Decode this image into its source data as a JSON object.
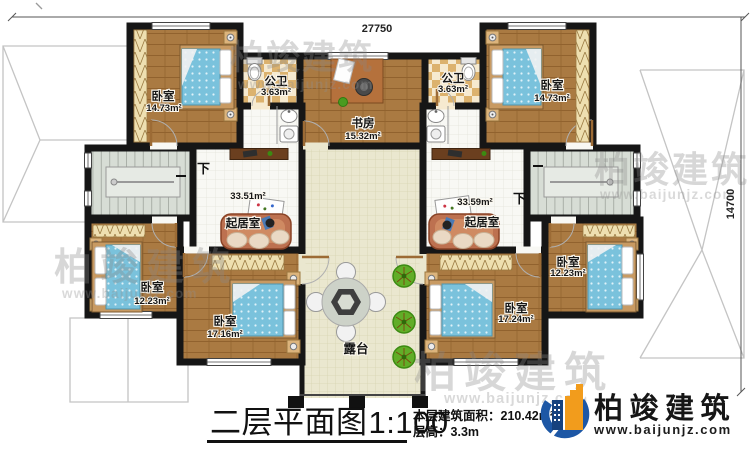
{
  "dimensions": {
    "top": "27750",
    "right": "14700"
  },
  "stairs": {
    "left_label": "下",
    "right_label": "下"
  },
  "rooms": {
    "bedroom_tl": {
      "name": "卧室",
      "area": "14.73m²"
    },
    "bath_l": {
      "name": "公卫",
      "area": "3.63m²"
    },
    "study": {
      "name": "书房",
      "area": "15.32m²"
    },
    "bath_r": {
      "name": "公卫",
      "area": "3.63m²"
    },
    "bedroom_tr": {
      "name": "卧室",
      "area": "14.73m²"
    },
    "living_l": {
      "name": "起居室",
      "area": "33.51m²"
    },
    "living_r": {
      "name": "起居室",
      "area": "33.59m²"
    },
    "bedroom_ml": {
      "name": "卧室",
      "area": "12.23m²"
    },
    "bedroom_bl": {
      "name": "卧室",
      "area": "17.16m²"
    },
    "bedroom_br": {
      "name": "卧室",
      "area": "17.24m²"
    },
    "bedroom_mr": {
      "name": "卧室",
      "area": "12.23m²"
    },
    "terrace": {
      "name": "露台"
    }
  },
  "title_block": {
    "plan_title": "二层平面图",
    "plan_scale": "1:100",
    "area_label": "本层建筑面积：",
    "area_value": "210.42m²",
    "height_label": "层高：",
    "height_value": "3.3m"
  },
  "logo": {
    "company": "柏竣建筑",
    "website": "www.baijunjz.com"
  },
  "watermark": {
    "line1": "柏竣建筑",
    "line2": "www.baijunjz.com"
  },
  "colors": {
    "accent_blue": "#1d57a5",
    "accent_orange": "#f29c1c",
    "wall": "#161616"
  }
}
